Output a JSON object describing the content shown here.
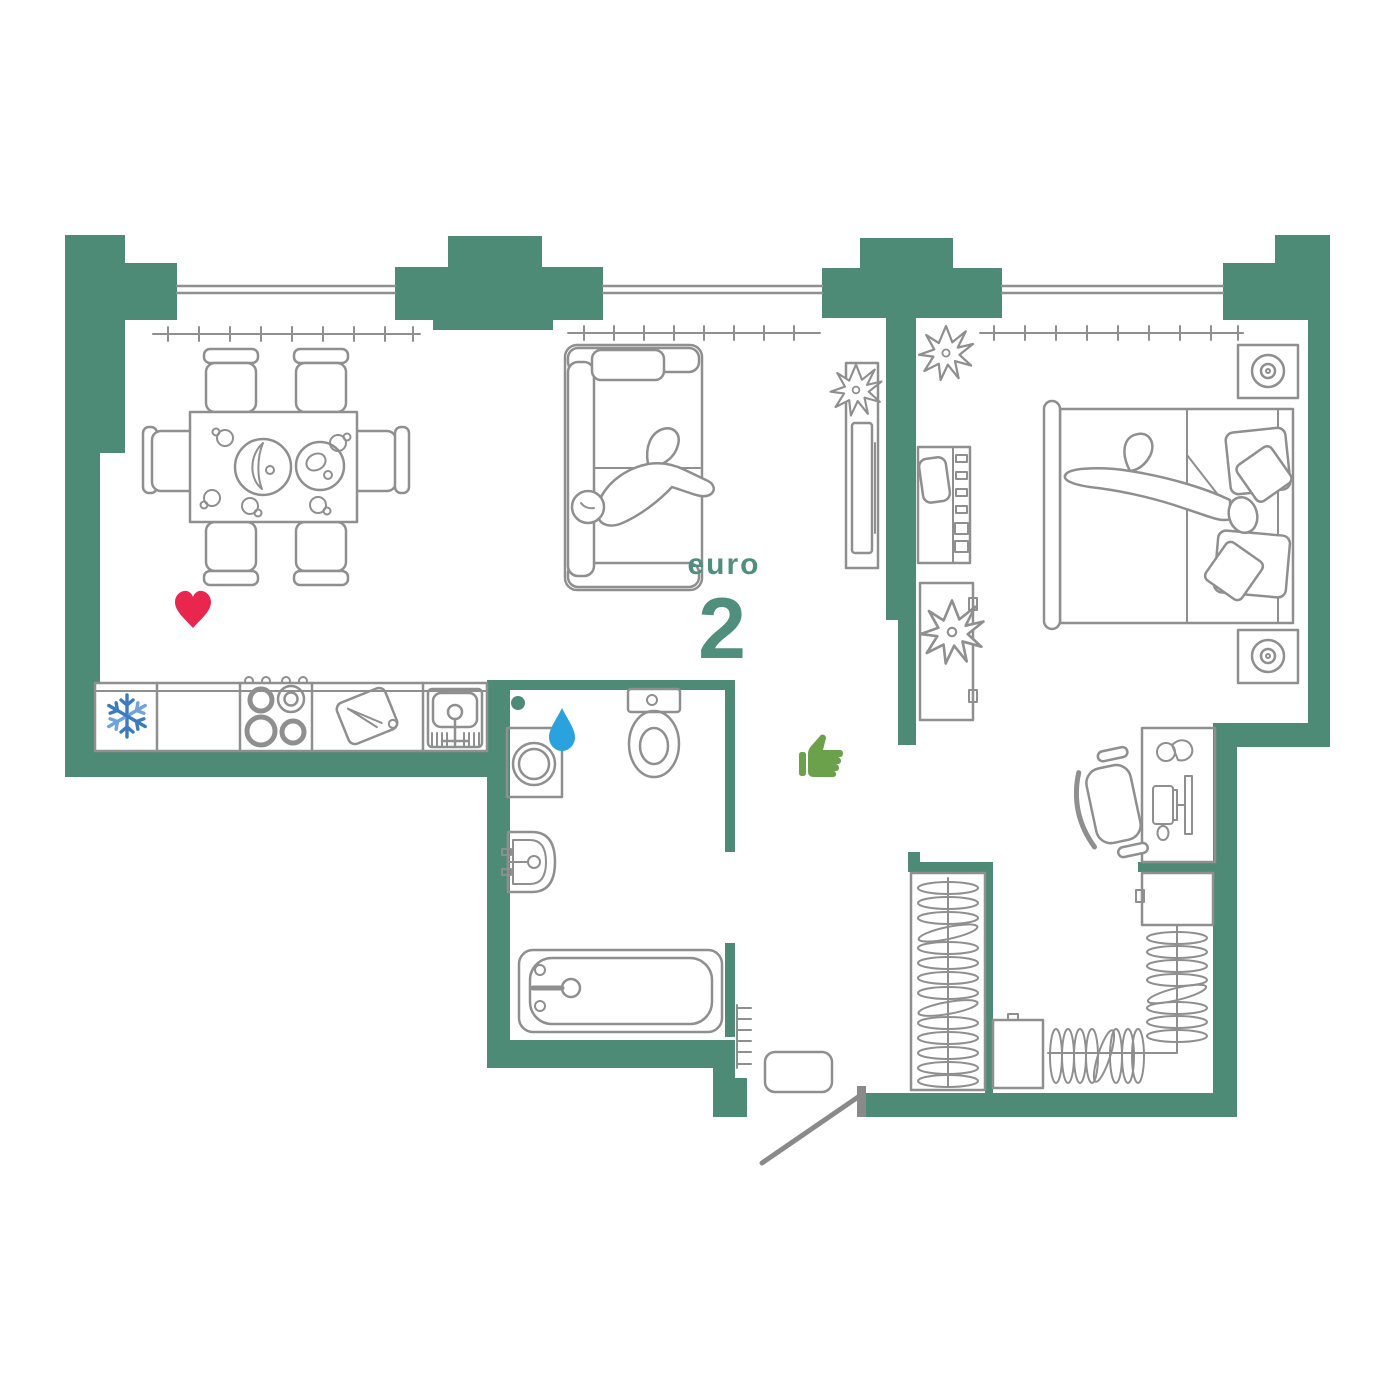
{
  "plan": {
    "label": {
      "prefix": "euro",
      "number": "2"
    },
    "colors": {
      "wall": "#4e8b77",
      "line": "#8f8f8f",
      "label": "#4f8f7b",
      "heart": "#e9264d",
      "snowflake": "#3c7bc0",
      "snowflake_light": "#6fa3dc",
      "drop": "#2aa2de",
      "thumbs_up": "#6ba14b",
      "dot": "#4e8b77",
      "door": "#8a8a8a"
    },
    "icons": [
      {
        "name": "heart-icon",
        "color": "#e9264d"
      },
      {
        "name": "snowflake-icon",
        "color": "#3c7bc0"
      },
      {
        "name": "water-drop-icon",
        "color": "#2aa2de"
      },
      {
        "name": "thumbs-up-icon",
        "color": "#6ba14b"
      },
      {
        "name": "dot-icon",
        "color": "#4e8b77"
      }
    ],
    "rooms": [
      {
        "name": "kitchen-living-room",
        "items": [
          "fridge",
          "stove",
          "cutting-board",
          "kitchen-sink",
          "dining-table",
          "chairs",
          "sofa",
          "tv-stand",
          "plant"
        ]
      },
      {
        "name": "bedroom",
        "items": [
          "double-bed",
          "pillows",
          "nightstands",
          "table-lamps",
          "makeup-desk",
          "stool",
          "cabinet",
          "plants",
          "work-desk",
          "office-chair",
          "monitor",
          "keyboard",
          "desk-lamp"
        ]
      },
      {
        "name": "bathroom",
        "items": [
          "washing-machine",
          "toilet",
          "wash-basin",
          "bathtub"
        ]
      },
      {
        "name": "hallway",
        "items": [
          "wardrobe",
          "hangers",
          "doormat",
          "entrance-door",
          "radiator"
        ]
      },
      {
        "name": "walk-in-closet",
        "items": [
          "wardrobe",
          "hangers",
          "cabinets"
        ]
      }
    ]
  }
}
